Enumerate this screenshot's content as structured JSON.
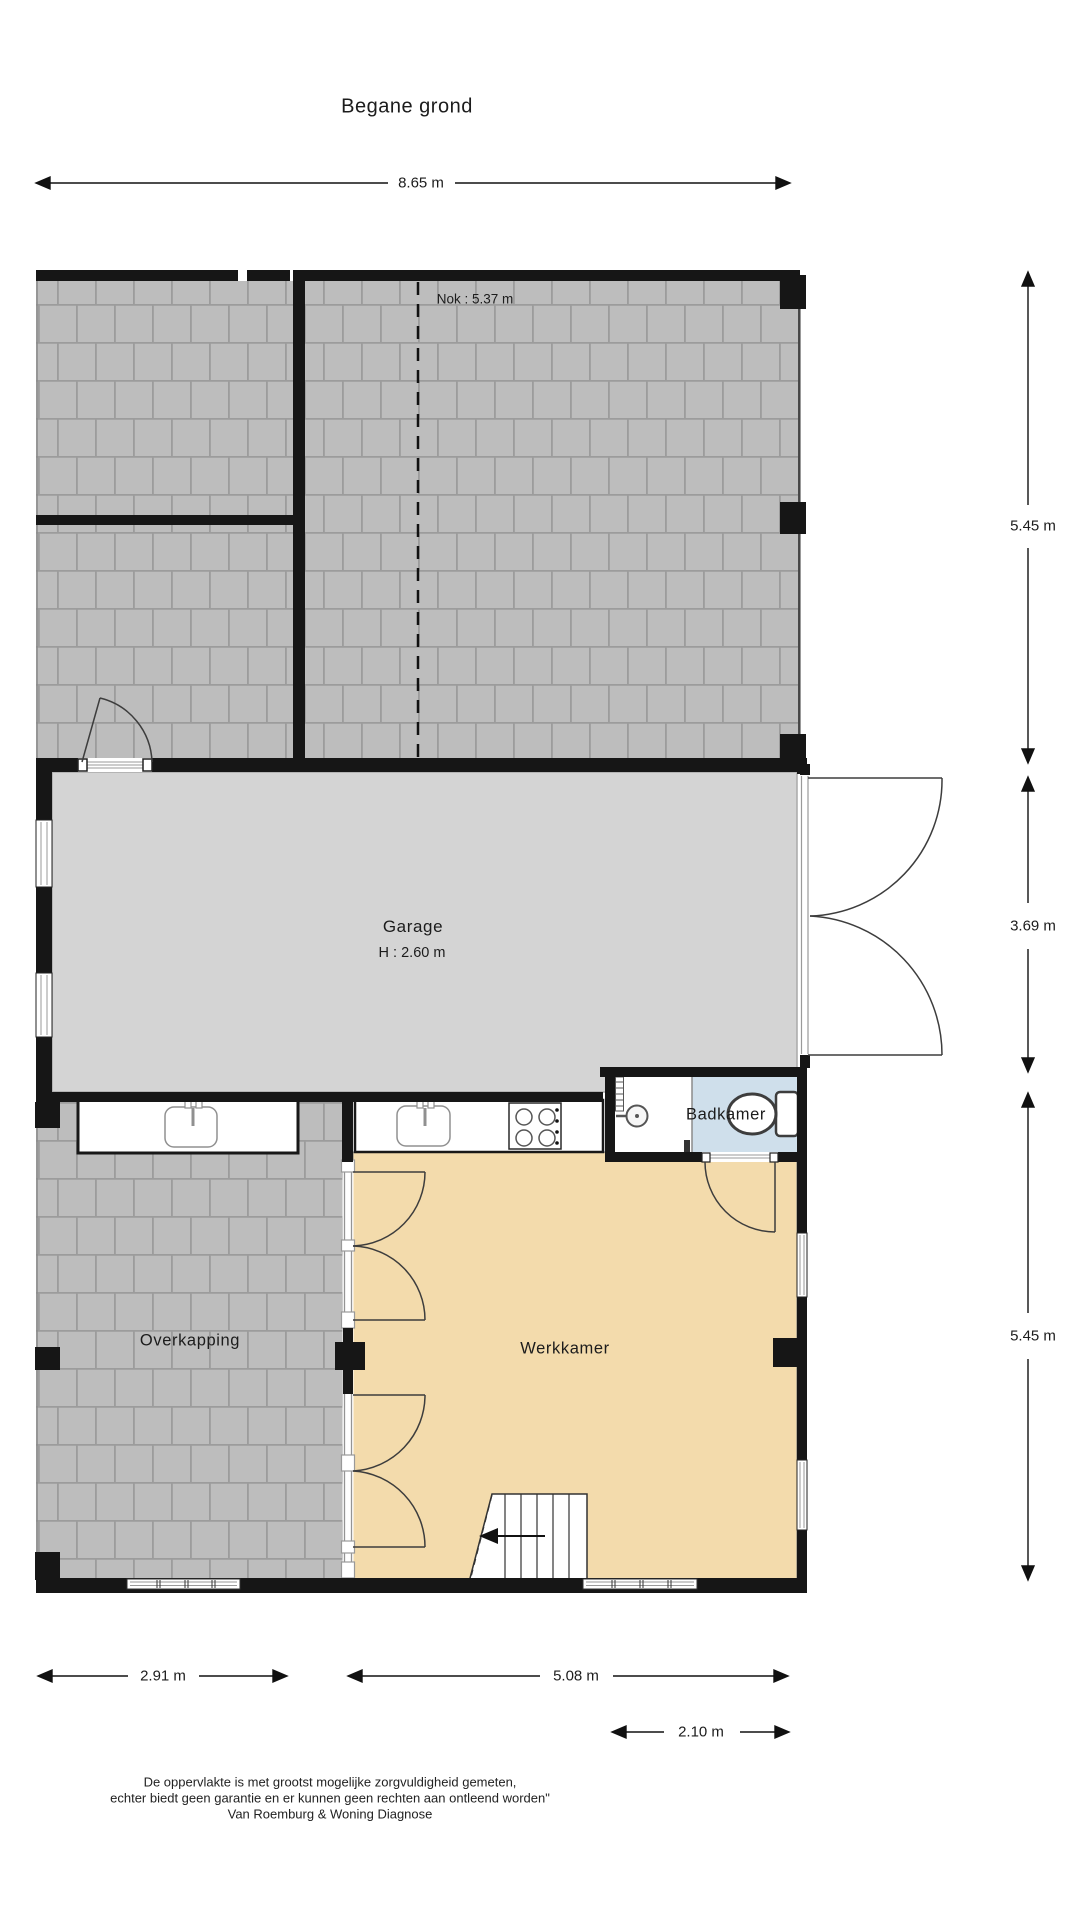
{
  "title": "Begane grond",
  "rooms": {
    "garage": {
      "label": "Garage",
      "height": "H : 2.60 m"
    },
    "badkamer": {
      "label": "Badkamer"
    },
    "overkapping": {
      "label": "Overkapping"
    },
    "werkkamer": {
      "label": "Werkkamer"
    }
  },
  "annotations": {
    "nok": "Nok : 5.37 m"
  },
  "dimensions": {
    "top": "8.65 m",
    "right_upper": "5.45 m",
    "right_middle": "3.69 m",
    "right_lower": "5.45 m",
    "bottom_left": "2.91 m",
    "bottom_middle": "5.08 m",
    "bottom_right": "2.10 m"
  },
  "footer": {
    "line1": "De oppervlakte is met grootst mogelijke zorgvuldigheid gemeten,",
    "line2": "echter biedt geen garantie en er kunnen geen rechten aan ontleend worden\"",
    "line3": "Van Roemburg & Woning Diagnose"
  },
  "colors": {
    "wall": "#161616",
    "paving_tile": "#bdbdbd",
    "paving_joint": "#9c9c9c",
    "garage_floor": "#d4d4d4",
    "werkkamer_floor": "#f3dbac",
    "badkamer_floor": "#cfdfeb",
    "fixture_outline": "#3d3d3d"
  }
}
